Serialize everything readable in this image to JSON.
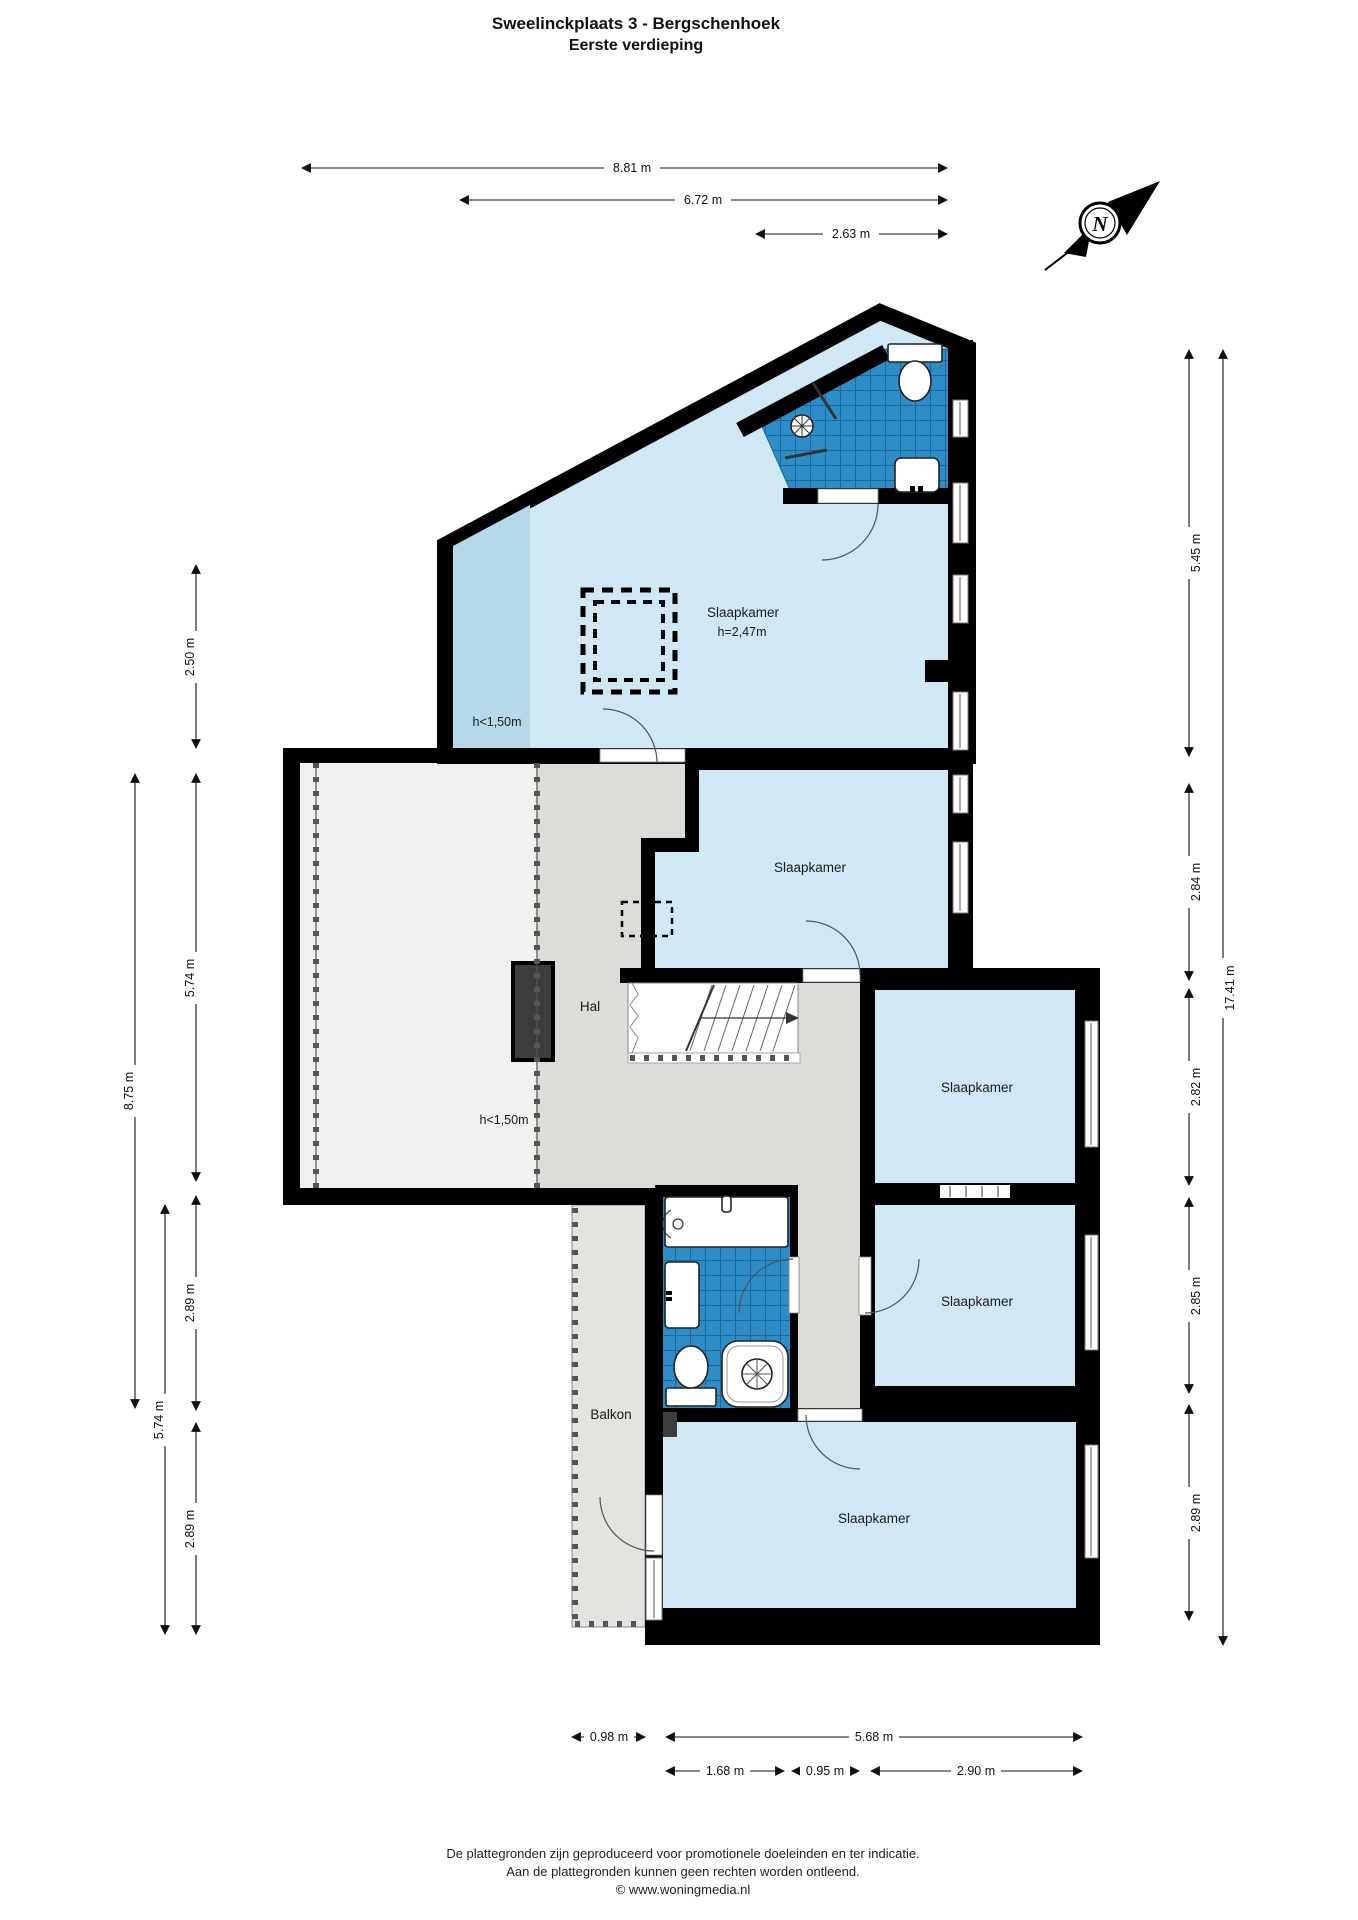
{
  "title": {
    "line1": "Sweelinckplaats 3 - Bergschenhoek",
    "line2": "Eerste verdieping"
  },
  "compass": {
    "letter": "N"
  },
  "rooms": {
    "attic": {
      "label": "Slaapkamer",
      "ceiling": "h=2,47m",
      "low": "h<1,50m"
    },
    "left_attic": {
      "low": "h<1,50m"
    },
    "mid": {
      "label": "Slaapkamer"
    },
    "right_upper": {
      "label": "Slaapkamer"
    },
    "right_lower": {
      "label": "Slaapkamer"
    },
    "bottom": {
      "label": "Slaapkamer"
    },
    "hall": {
      "label": "Hal"
    },
    "balcony": {
      "label": "Balkon"
    }
  },
  "dimensions": {
    "top": [
      "8.81 m",
      "6.72 m",
      "2.63 m"
    ],
    "left": [
      "2.50 m",
      "5.74 m",
      "8.75 m",
      "2.89 m",
      "5.74 m",
      "2.89 m"
    ],
    "right": [
      "5.45 m",
      "2.84 m",
      "2.82 m",
      "2.85 m",
      "2.89 m",
      "17.41 m"
    ],
    "bottom": [
      "0.98 m",
      "5.68 m",
      "1.68 m",
      "0.95 m",
      "2.90 m"
    ]
  },
  "footer": {
    "line1": "De plattegronden zijn geproduceerd voor promotionele doeleinden en ter indicatie.",
    "line2": "Aan de plattegronden kunnen geen rechten worden ontleend.",
    "line3": "© www.woningmedia.nl"
  },
  "colors": {
    "wall": "#000000",
    "room": "#cfe8f4",
    "room_low": "#b5d9e9",
    "tile": "#2e8cc7",
    "tile_grid": "#19699f",
    "hall": "#dedcd8",
    "attic_floor": "#f1f0ee",
    "balcony": "#e4e3df",
    "dark_block": "#3d3d3d"
  }
}
